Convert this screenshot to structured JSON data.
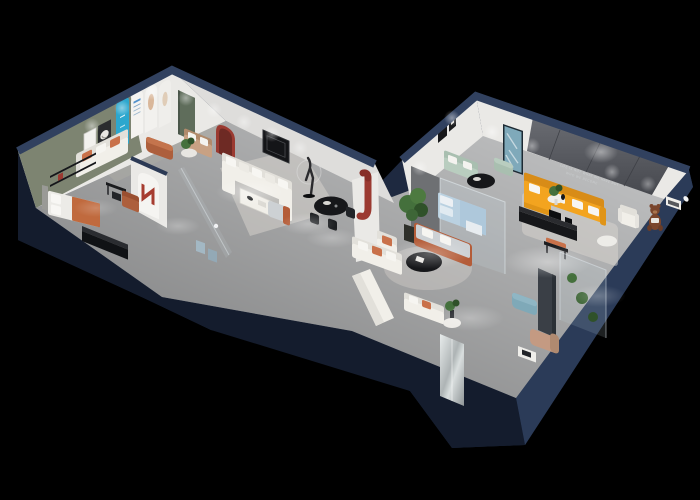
{
  "scene": {
    "description": "3D isometric cutaway floor plan render of a furnished showroom apartment on a black background",
    "wall_sign": {
      "line1": "LIFE IS NOT WHAT WE HAVE BUT",
      "line2": "WHO WE BECOME"
    }
  },
  "colors": {
    "background": "#000000",
    "navy_outer": "#1e2940",
    "navy_face_se": "#2b3b58",
    "navy_face_sw": "#141c2d",
    "navy_cap": "#31415f",
    "floor": "#c5c6c7",
    "wall_white": "#eae9e6",
    "wall_shaded": "#dedddb",
    "wall_olive": "#7d8471",
    "accent_wall": "#5d5f65",
    "backdrop_gray": "#6e7073",
    "arch_cyan": "#2ca7ce",
    "red_accent": "#9b3a31",
    "door_green": "#5f6d5b",
    "sofa_white": "#f1efe9",
    "sofa_back_white": "#e2e0da",
    "cushion_orange": "#c9714a",
    "leather_caramel": "#ad5f3c",
    "sofa_sage": "#a9bfb0",
    "sofa_yellow": "#f3a41f",
    "sofa_yellow_dark": "#d88c17",
    "rust_frame": "#b45c38",
    "gray_cushion": "#cdd1d4",
    "table_black": "#16171a",
    "wood_tan": "#c8a183",
    "bed_blue": "#b7cfdf",
    "ottoman_blue": "#7fa9b8",
    "chaise_tan": "#c49a82",
    "plant_green": "#44703c",
    "plant_dark": "#2f5129",
    "bear_brown": "#7a452c",
    "rug_light": "#d9d6cf",
    "rug_olive": "#abaca4",
    "mirror_silver": "#b7bbbc",
    "glass_tint": "#d8e6ee",
    "statue_dark": "#2b2b2e",
    "sign_text": "#cdd0d2"
  }
}
